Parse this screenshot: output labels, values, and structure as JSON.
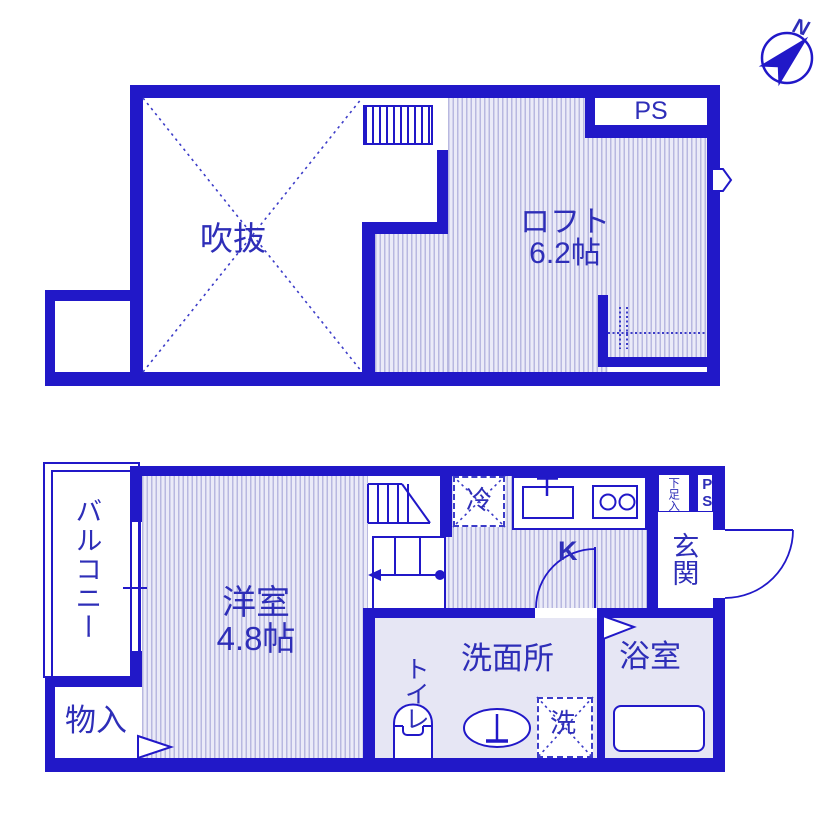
{
  "colors": {
    "wall": "#2118c8",
    "text": "#2e2eb8",
    "hatch_bg": "#ebebf8",
    "hatch_line": "#b8b8e0",
    "room_fill": "#e6e6f4",
    "dash": "#3c3cc8"
  },
  "compass": {
    "north_label": "N"
  },
  "upper_floor": {
    "void": {
      "name": "吹抜"
    },
    "loft": {
      "name": "ロフト",
      "size": "6.2帖"
    },
    "pipe_space": {
      "name": "PS"
    }
  },
  "lower_floor": {
    "balcony": {
      "name": "バルコニー"
    },
    "western_room": {
      "name": "洋室",
      "size": "4.8帖"
    },
    "storage": {
      "name": "物入"
    },
    "kitchen": {
      "name": "K"
    },
    "refrigerator": {
      "name": "冷"
    },
    "entrance": {
      "name": "玄関"
    },
    "shoe_cabinet": {
      "name": "下足入"
    },
    "pipe_space": {
      "name": "PS"
    },
    "washroom": {
      "name": "洗面所"
    },
    "toilet": {
      "name": "トイレ"
    },
    "washer": {
      "name": "洗"
    },
    "bathroom": {
      "name": "浴室"
    }
  }
}
